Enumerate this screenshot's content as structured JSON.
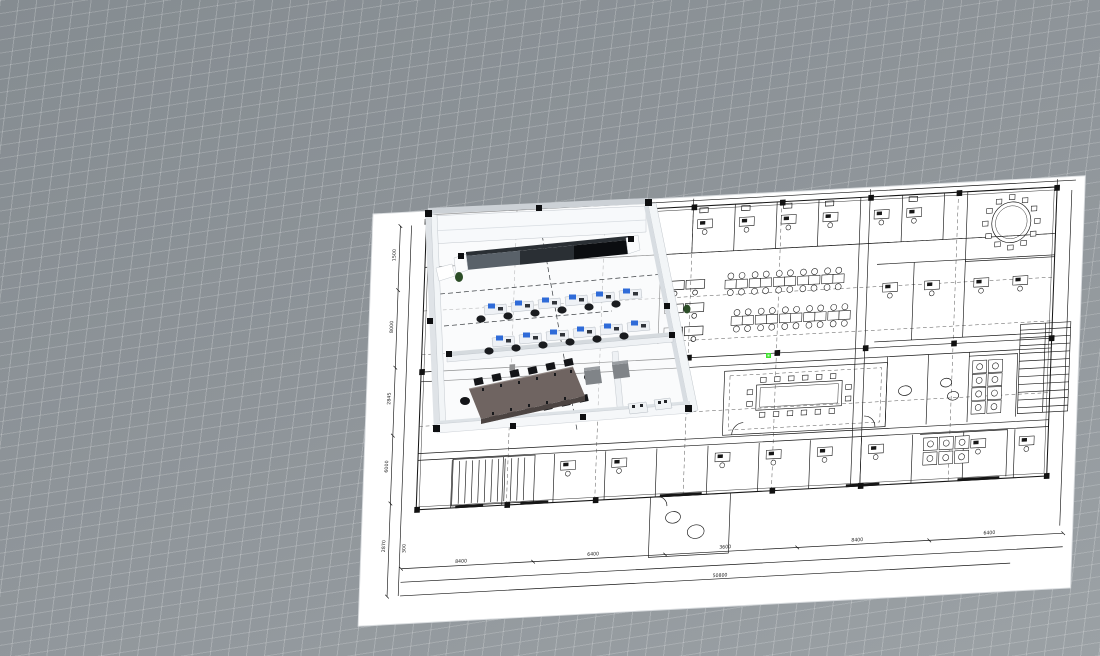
{
  "viewport": {
    "width": 1100,
    "height": 656,
    "background_top": "#858c91",
    "background_bottom": "#9ba1a5",
    "grid_line_color": "#b8bdc1",
    "snap_marker_color": "#3fe22f"
  },
  "sheet": {
    "paper_color": "#ffffff",
    "ink_color": "#161616",
    "dim_left": [
      "1500",
      "8000",
      "2845",
      "6000",
      "2870"
    ],
    "dim_bottom": [
      "8400",
      "6400",
      "3600",
      "8400",
      "6400"
    ],
    "dim_overall": "50800",
    "dim_interior": "300"
  },
  "model": {
    "wall_color": "#f2f5f7",
    "wall_top_color": "#d5dade",
    "glass_colors": [
      "#596169",
      "#2a2f34",
      "#0b0d10"
    ],
    "desk_color": "#eef1f5",
    "accent_color": "#2f6bd8",
    "chair_color": "#1a1c1f",
    "table_color": "#6f6461",
    "cabinet_color": "#808488",
    "plant_color": "#2c4d27",
    "workstation_rows": 2,
    "workstations_per_row": 6,
    "conference_chairs": 14
  }
}
